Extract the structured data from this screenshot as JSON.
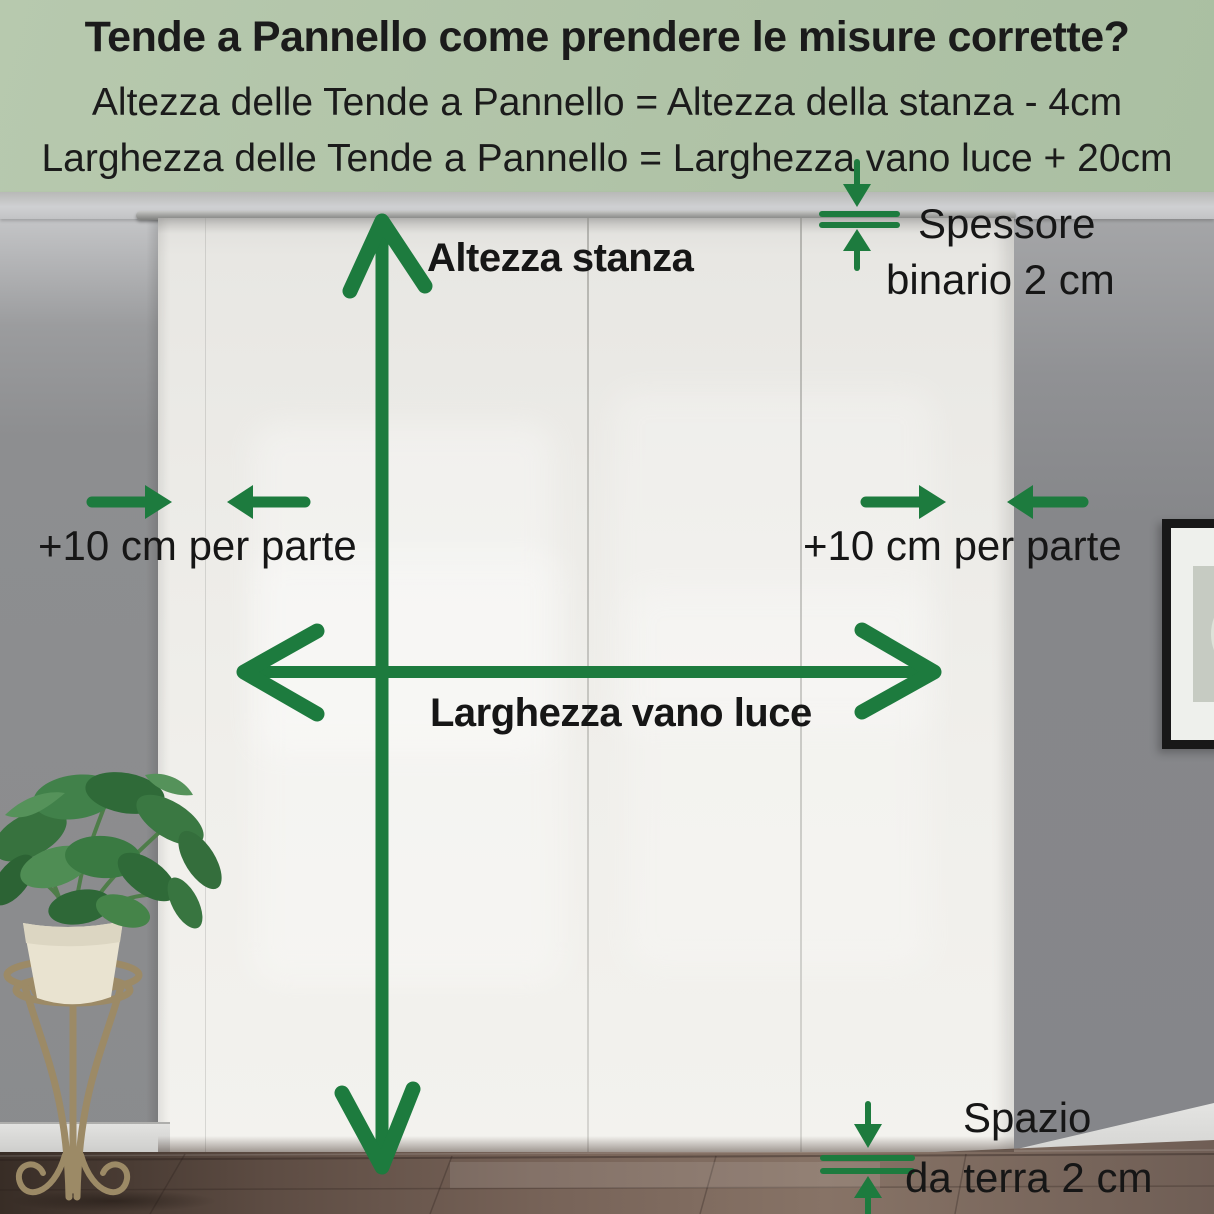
{
  "header": {
    "title": "Tende a Pannello come prendere le misure corrette?",
    "formula_height": "Altezza delle Tende a Pannello = Altezza della stanza - 4cm",
    "formula_width": "Larghezza delle Tende a Pannello = Larghezza vano luce + 20cm"
  },
  "labels": {
    "room_height": "Altezza stanza",
    "opening_width": "Larghezza vano luce",
    "margin_left": "+10 cm per parte",
    "margin_right": "+10 cm per parte",
    "rail_thickness_line1": "Spessore",
    "rail_thickness_line2": "binario 2 cm",
    "floor_gap_line1": "Spazio",
    "floor_gap_line2": "da terra 2 cm"
  },
  "icons": {
    "room_height_icon": "vertical-double-arrow",
    "opening_width_icon": "horizontal-double-arrow",
    "margin_icons": "inward-pointing-arrows",
    "rail_thickness_icon": "thickness-gauge-arrows",
    "floor_gap_icon": "thickness-gauge-arrows"
  },
  "colors": {
    "accent_green": "#1d7b3e",
    "header_background": "#b0c3a7",
    "text": "#161616",
    "wall_gray": "#8a8b8d",
    "curtain_white": "#f0efeb",
    "floor_brown": "#6f5e55"
  }
}
